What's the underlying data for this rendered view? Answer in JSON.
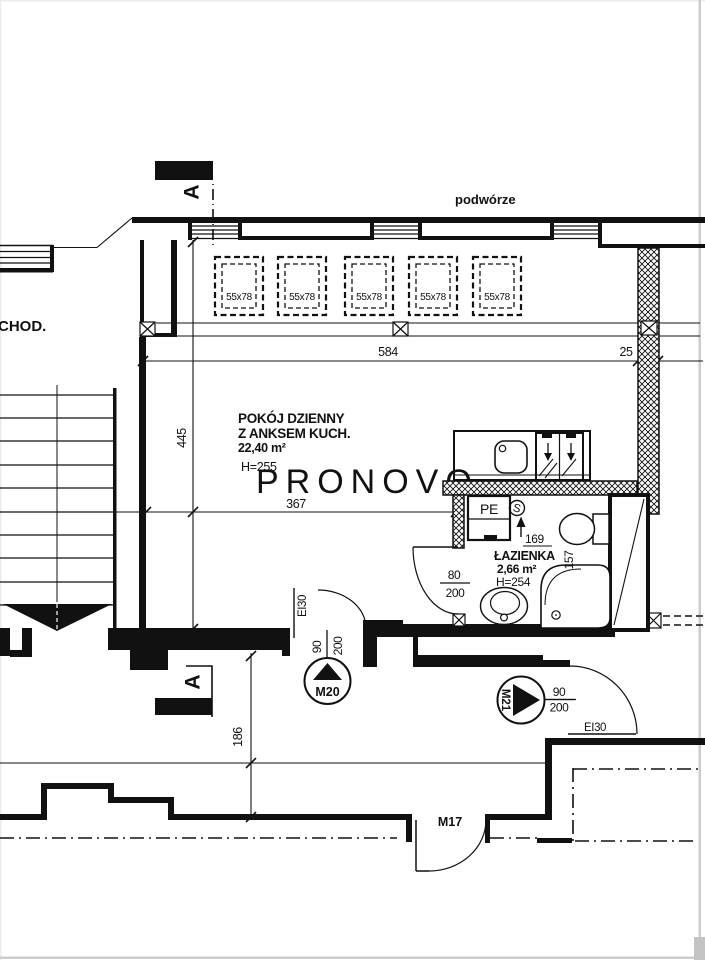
{
  "colors": {
    "ink": "#111111",
    "watermark": "#d9d9d9",
    "sheet_edge": "#cccccc"
  },
  "plan": {
    "watermark": "PRONOVO",
    "courtyard_label": "podwórze",
    "adjacent_room_label": "CHOD.",
    "section_marker": "A",
    "skylight_size": "55x78",
    "symbols": {
      "gas_point": "S"
    },
    "living_room": {
      "name_line1": "POKÓJ DZIENNY",
      "name_line2": "Z ANKSEM KUCH.",
      "area": "22,40 m²",
      "ceiling_height": "H=255"
    },
    "bathroom": {
      "name": "ŁAZIENKA",
      "area": "2,66 m²",
      "ceiling_height": "H=254",
      "pe_label": "PE"
    },
    "dimensions": {
      "top_span": "584",
      "pillar_width": "25",
      "room_depth": "445",
      "room_width": "367",
      "bottom_offset": "186",
      "bath_width": "169",
      "bath_depth": "157"
    },
    "doors": {
      "m20": {
        "id": "M20",
        "width": "90",
        "height": "200",
        "fire_rating": "EI30"
      },
      "m21": {
        "id": "M21",
        "width": "90",
        "height": "200",
        "fire_rating": "EI30"
      },
      "m17": {
        "id": "M17"
      },
      "bathroom_door": {
        "width": "80",
        "height": "200"
      }
    }
  }
}
